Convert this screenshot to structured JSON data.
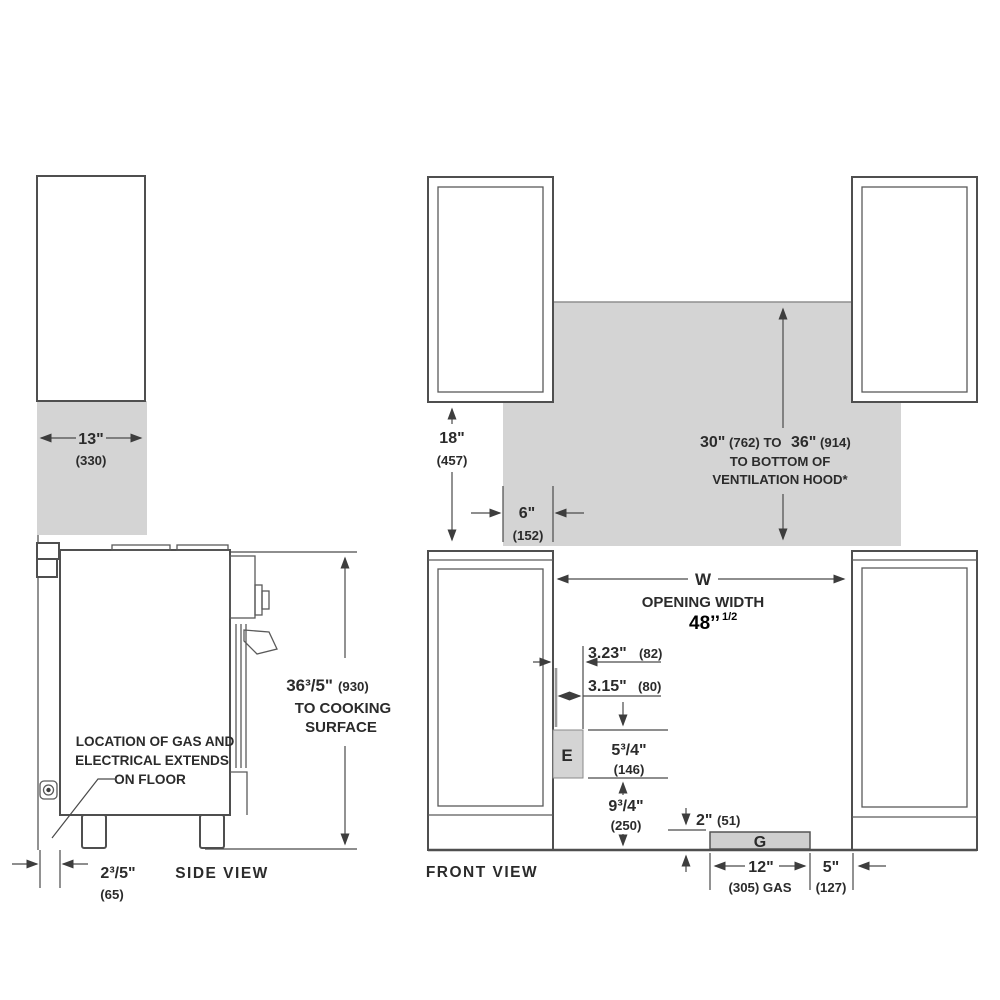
{
  "side": {
    "view_label": "SIDE  VIEW",
    "dim13": {
      "in": "13\"",
      "mm": "(330)"
    },
    "dim36": {
      "in": "36³/5\"",
      "mm": "(930)",
      "l2": "TO COOKING",
      "l3": "SURFACE"
    },
    "note": {
      "l1": "LOCATION OF GAS AND",
      "l2": "ELECTRICAL EXTENDS",
      "l3": "ON FLOOR"
    },
    "dim26": {
      "in": "2³/5\"",
      "mm": "(65)"
    }
  },
  "front": {
    "view_label": "FRONT VIEW",
    "dim18": {
      "in": "18\"",
      "mm": "(457)"
    },
    "dim6": {
      "in": "6\"",
      "mm": "(152)"
    },
    "hood": {
      "p1": "30\"",
      "p2": "(762) TO",
      "p3": "36\"",
      "p4": "(914)",
      "l2": "TO BOTTOM OF",
      "l3": "VENTILATION HOOD*"
    },
    "w": {
      "sym": "W",
      "label": "OPENING WIDTH",
      "val": "48’’",
      "sup": "1/2"
    },
    "d323": {
      "in": "3.23\"",
      "mm": "(82)"
    },
    "d315": {
      "in": "3.15\"",
      "mm": "(80)"
    },
    "e_label": "E",
    "d575": {
      "in": "5³/4\"",
      "mm": "(146)"
    },
    "d975": {
      "in": "9³/4\"",
      "mm": "(250)"
    },
    "d2": {
      "in": "2\"",
      "mm": "(51)"
    },
    "g_label": "G",
    "d12": {
      "in": "12\"",
      "mm": "(305) GAS"
    },
    "d5": {
      "in": "5\"",
      "mm": "(127)"
    }
  }
}
